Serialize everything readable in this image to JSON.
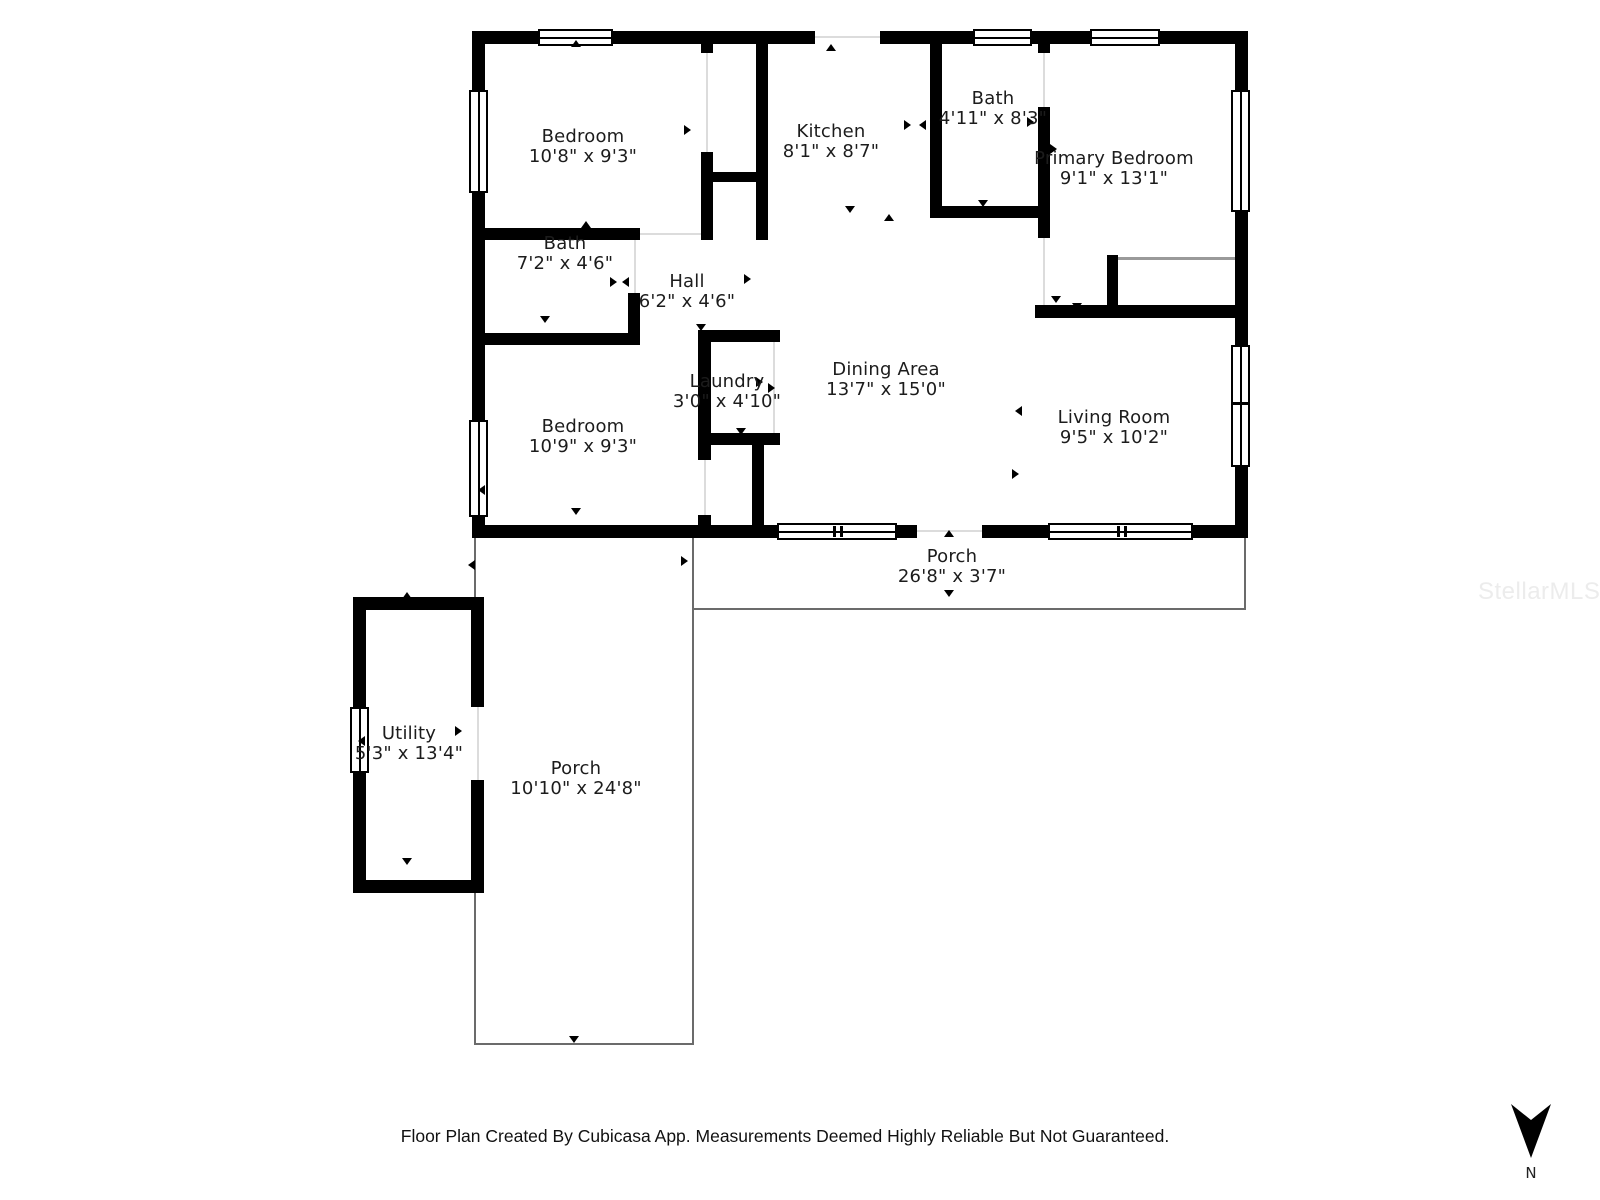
{
  "rooms": [
    {
      "name": "Bedroom",
      "dims": "10'8\" x 9'3\""
    },
    {
      "name": "Kitchen",
      "dims": "8'1\" x 8'7\""
    },
    {
      "name": "Bath",
      "dims": "4'11\" x 8'3\""
    },
    {
      "name": "Primary Bedroom",
      "dims": "9'1\" x 13'1\""
    },
    {
      "name": "Bath",
      "dims": "7'2\" x 4'6\""
    },
    {
      "name": "Hall",
      "dims": "6'2\" x 4'6\""
    },
    {
      "name": "Laundry",
      "dims": "3'0\" x 4'10\""
    },
    {
      "name": "Dining Area",
      "dims": "13'7\" x 15'0\""
    },
    {
      "name": "Bedroom",
      "dims": "10'9\" x 9'3\""
    },
    {
      "name": "Living Room",
      "dims": "9'5\" x 10'2\""
    },
    {
      "name": "Porch",
      "dims": "26'8\" x 3'7\""
    },
    {
      "name": "Utility",
      "dims": "5'3\" x 13'4\""
    },
    {
      "name": "Porch",
      "dims": "10'10\" x 24'8\""
    }
  ],
  "footer": {
    "text": "Floor Plan Created By Cubicasa App. Measurements Deemed Highly Reliable But Not Guaranteed."
  },
  "compass": {
    "label": "N"
  },
  "watermark": {
    "text": "StellarMLS"
  },
  "palette": {
    "wall": "#000000",
    "porch_line": "#6b6b6b",
    "label_text": "#1c1c1c",
    "watermark_text": "#ececec"
  }
}
